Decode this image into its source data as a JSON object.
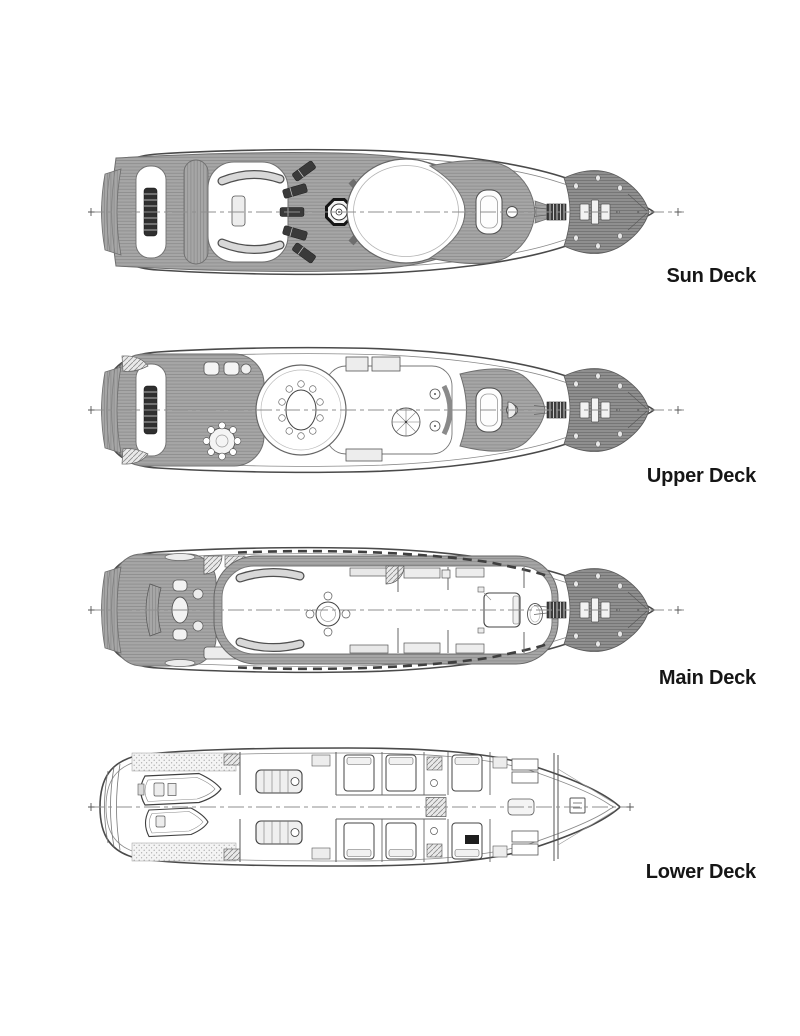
{
  "figure": {
    "subject": "yacht-deck-plans",
    "orientation": "bow-right",
    "colors": {
      "background": "#ffffff",
      "outline": "#4a4a4a",
      "teak_deck": "#a6a6a6",
      "foredeck": "#8f8f8f",
      "dark_detail": "#3a3a3a",
      "label_text": "#161616"
    }
  },
  "decks": [
    {
      "id": "sun-deck",
      "label": "Sun Deck"
    },
    {
      "id": "upper-deck",
      "label": "Upper Deck"
    },
    {
      "id": "main-deck",
      "label": "Main Deck"
    },
    {
      "id": "lower-deck",
      "label": "Lower Deck"
    }
  ]
}
